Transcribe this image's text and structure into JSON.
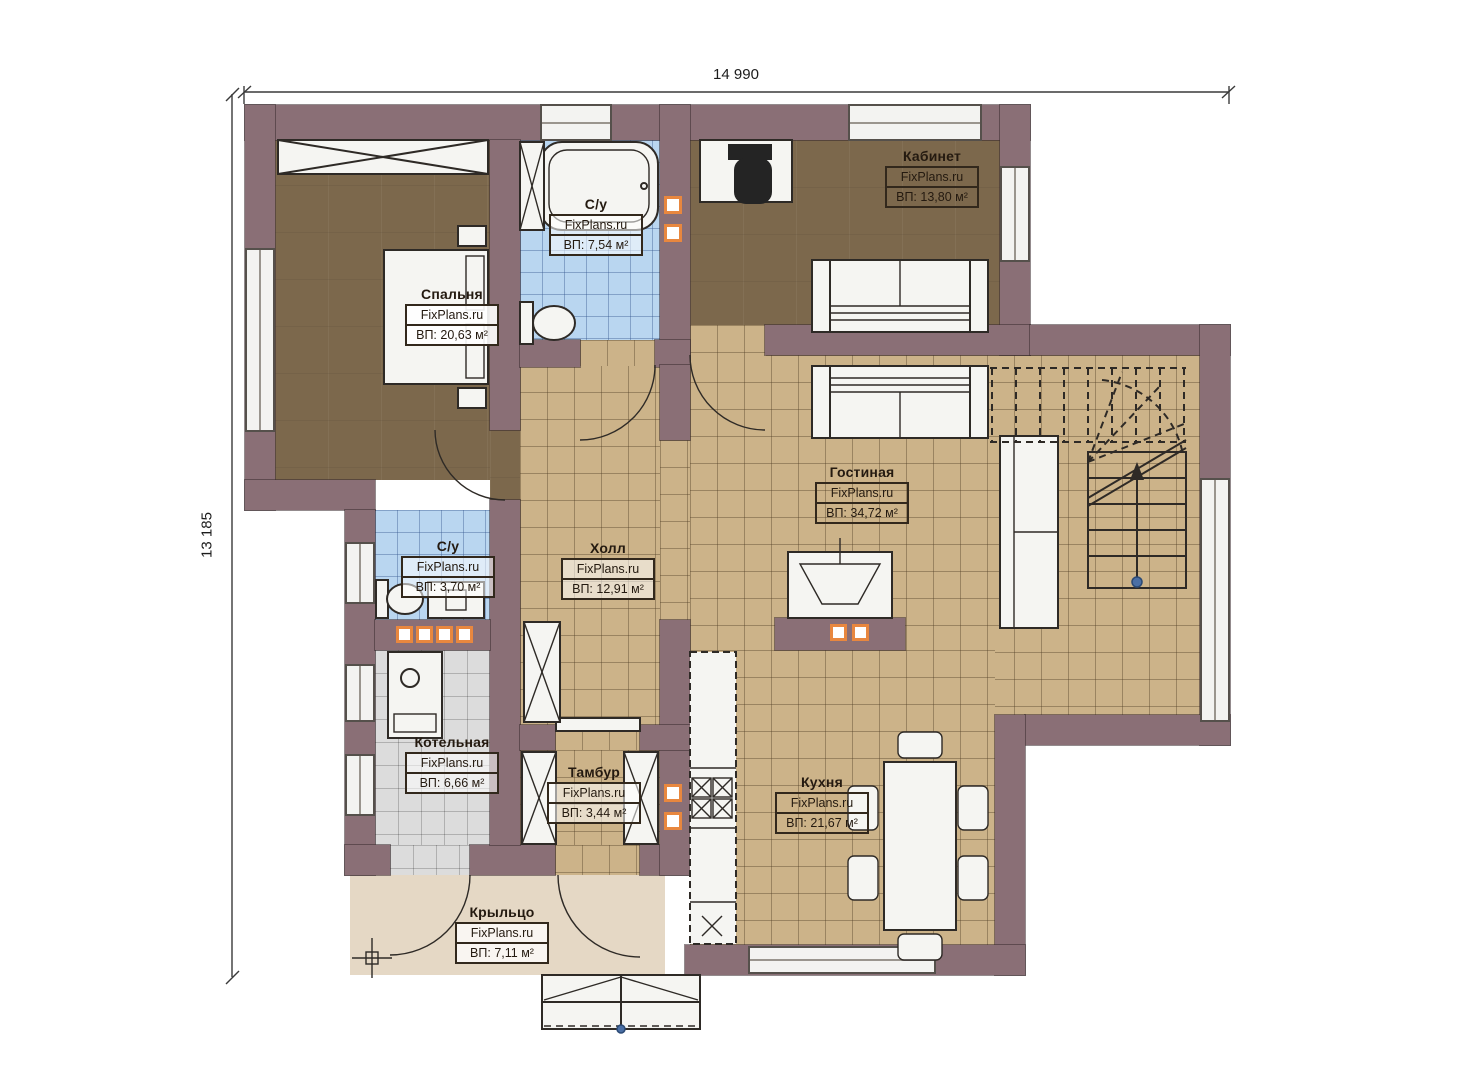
{
  "watermark": "FixPlans.ru",
  "dimensions": {
    "width": "14 990",
    "height": "13 185"
  },
  "rooms": [
    {
      "key": "bedroom",
      "name": "Спальня",
      "area": "ВП: 20,63 м²"
    },
    {
      "key": "bathroom-top",
      "name": "С/у",
      "area": "ВП: 7,54 м²"
    },
    {
      "key": "office",
      "name": "Кабинет",
      "area": "ВП: 13,80 м²"
    },
    {
      "key": "living-room",
      "name": "Гостиная",
      "area": "ВП: 34,72 м²"
    },
    {
      "key": "hall",
      "name": "Холл",
      "area": "ВП: 12,91 м²"
    },
    {
      "key": "bathroom-small",
      "name": "С/у",
      "area": "ВП: 3,70 м²"
    },
    {
      "key": "boiler-room",
      "name": "Котельная",
      "area": "ВП: 6,66 м²"
    },
    {
      "key": "vestibule",
      "name": "Тамбур",
      "area": "ВП: 3,44 м²"
    },
    {
      "key": "kitchen",
      "name": "Кухня",
      "area": "ВП: 21,67 м²"
    },
    {
      "key": "porch",
      "name": "Крыльцо",
      "area": "ВП: 7,11 м²"
    }
  ],
  "colors": {
    "wall": "#8a6f76",
    "floor_wood": "#7c684c",
    "floor_tile_tan": "#ccb389",
    "floor_tile_blue": "#b9d6f0",
    "floor_tile_gray": "#dcdcdc",
    "porch": "#e5d8c5",
    "vent_accent": "#e8873f",
    "stair_arrow_dot": "#4a6fa5"
  }
}
